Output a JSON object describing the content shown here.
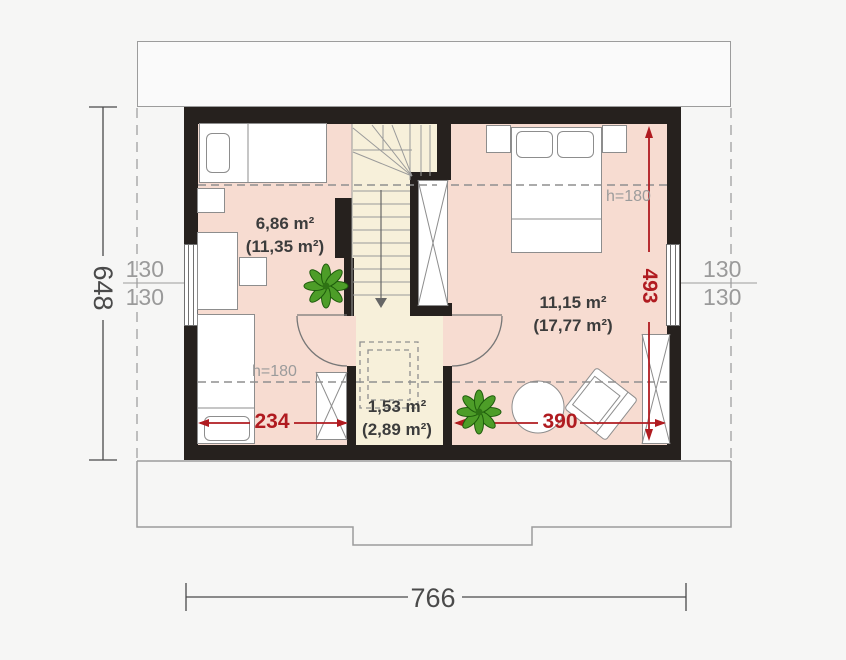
{
  "rooms": {
    "left": {
      "area": "6,86 m²",
      "area_gross": "(11,35 m²)"
    },
    "right": {
      "area": "11,15 m²",
      "area_gross": "(17,77 m²)"
    },
    "hall": {
      "area": "1,53 m²",
      "area_gross": "(2,89 m²)"
    }
  },
  "dimensions": {
    "overall_width": "766",
    "overall_depth": "648",
    "room_left_width": "234",
    "room_right_width": "390",
    "room_right_depth": "493",
    "window_left": {
      "top": "130",
      "bottom": "130"
    },
    "window_right": {
      "top": "130",
      "bottom": "130"
    },
    "knee_wall_left": "h=180",
    "knee_wall_right": "h=180"
  },
  "colors": {
    "wall": "#26211e",
    "floor_room": "#f7dcd1",
    "floor_hall": "#f7f0da",
    "dimension_red": "#b01b20",
    "dimension_dark_gray": "#4a4a4a",
    "label_light_gray": "#9a9a9a",
    "plant_green": "#4d9d28"
  }
}
